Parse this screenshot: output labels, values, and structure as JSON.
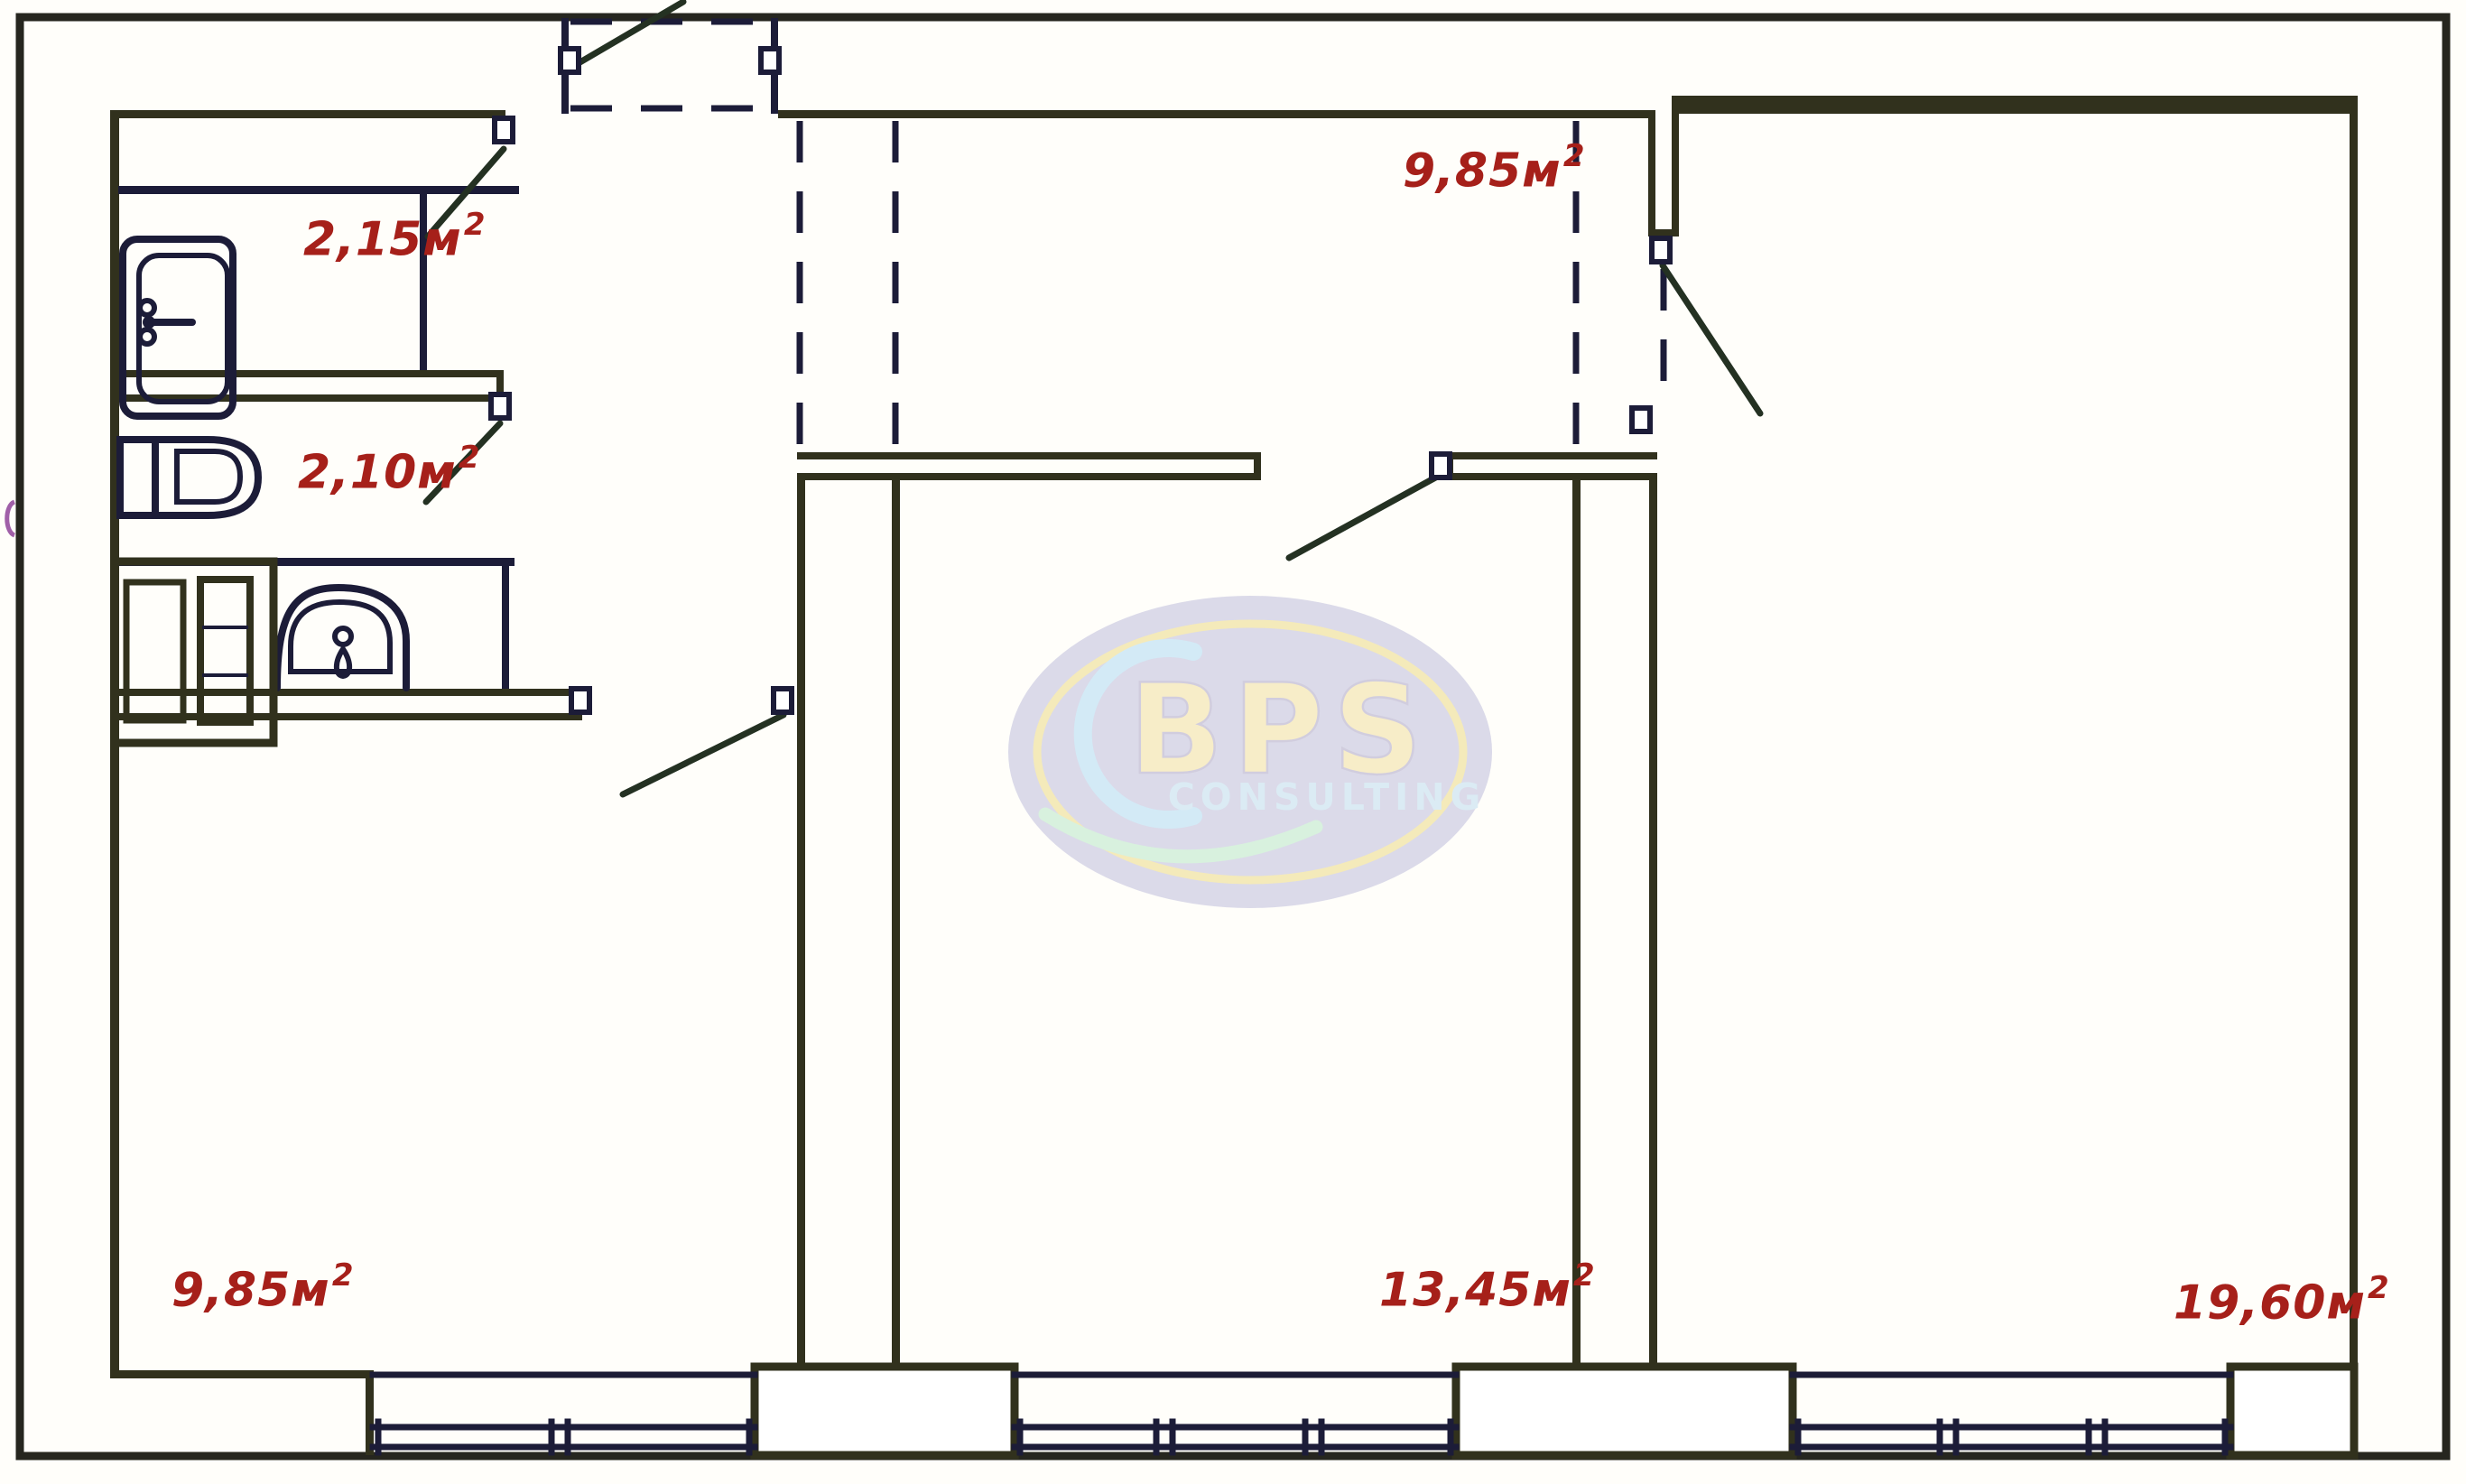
{
  "title": "apartment-floor-plan",
  "colors": {
    "background": "#fffefa",
    "wall": "#31311d",
    "fixture": "#1c1c38",
    "door_swing": "#243122",
    "label": "#a6201a",
    "frame": "#26261f",
    "wm_ellipse": "#9a99c9",
    "wm_ring": "#e8d26d",
    "wm_brand": "#eed98c",
    "wm_sub": "#b0d6ee",
    "wm_crescent": "#9ed2f3",
    "wm_swoosh": "#a9e2bd"
  },
  "labels": {
    "bath": {
      "text": "2,15м",
      "sup": "2"
    },
    "wc": {
      "text": "2,10м",
      "sup": "2"
    },
    "hall_top": {
      "text": "9,85м",
      "sup": "2"
    },
    "room_left": {
      "text": "9,85м",
      "sup": "2"
    },
    "room_middle": {
      "text": "13,45м",
      "sup": "2"
    },
    "room_right": {
      "text": "19,60м",
      "sup": "2"
    }
  },
  "areas_m2": {
    "bath": "2,15",
    "wc": "2,10",
    "hall_top": "9,85",
    "room_left": "9,85",
    "room_middle": "13,45",
    "room_right": "19,60"
  },
  "watermark": {
    "brand": "BPS",
    "subtitle": "CONSULTING"
  }
}
